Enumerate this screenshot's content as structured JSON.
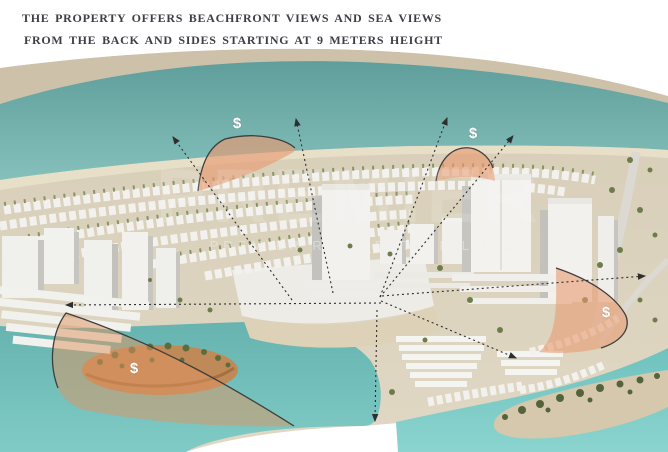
{
  "page": {
    "title_line1": "THE PROPERTY OFFERS BEACHFRONT VIEWS AND SEA VIEWS",
    "title_line2": "FROM THE BACK AND SIDES STARTING AT 9 METERS HEIGHT"
  },
  "watermark": {
    "brand": "PREMIER",
    "company_line": "PREMIER REAL ESTATE L.L.C."
  },
  "markers": [
    {
      "label": "$"
    },
    {
      "label": "$"
    },
    {
      "label": "$"
    },
    {
      "label": "$"
    }
  ],
  "colors": {
    "sea": "#6aa8a4",
    "lagoon_left": "#72bdb9",
    "lagoon_right": "#7ecdc8",
    "far_sand": "#cfc3ac",
    "island_sand": "#dbd2bd",
    "beach": "#e7dfc8",
    "building_face": "#f2f1ee",
    "building_side": "#c6c5c0",
    "vegetation": "#74854f",
    "highlight_zone": "#e89b72",
    "annotation_line": "#2e2e2e",
    "title_text": "#3e3f45"
  }
}
